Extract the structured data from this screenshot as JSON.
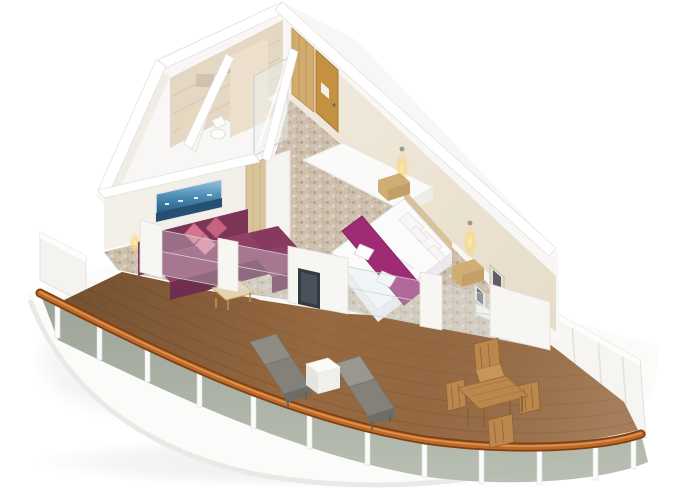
{
  "scene": {
    "type": "isometric-3d-cutaway-render",
    "subject": "cruise-ship-balcony-suite-floorplan"
  },
  "rooms": [
    "entry-hall",
    "bathroom",
    "shower-room",
    "living-area",
    "bedroom",
    "balcony"
  ],
  "counts": {
    "railing_posts": 12,
    "dining_chairs": 4,
    "loungers": 2
  },
  "colors": {
    "background": "#ffffff",
    "hull": "#fbfbf9",
    "deck_wood": "#976940",
    "handrail": "#bf6827",
    "railing_glass": "#a9b1a3",
    "carpet_base": "#cec0af",
    "wall_white": "#f6f5f2",
    "wall_cream": "#ede5d6",
    "tile_beige": "#e4d8c4",
    "divider_wood": "#d9c49a",
    "sofa": "#8e4066",
    "sofa_dark": "#6f2e4d",
    "pillow_pink": "#d4758f",
    "bed_white": "#fcfbfb",
    "bed_runner": "#9e2b74",
    "headboard_wood": "#d8c29a",
    "nightstand_wood": "#d0ad72",
    "door_gold": "#c3913f",
    "closet_wood": "#d2ab6e",
    "artwork_blue": "#3e7ca8",
    "sconce_glow": "#f6d87f",
    "tv_dark": "#343a41",
    "lounger_gray": "#8f8c84",
    "outdoor_table_white": "#fbfbf9",
    "dining_wood": "#bc874c",
    "frame_dark": "#5c5f6b",
    "shower_glass": "#eef2f2"
  }
}
